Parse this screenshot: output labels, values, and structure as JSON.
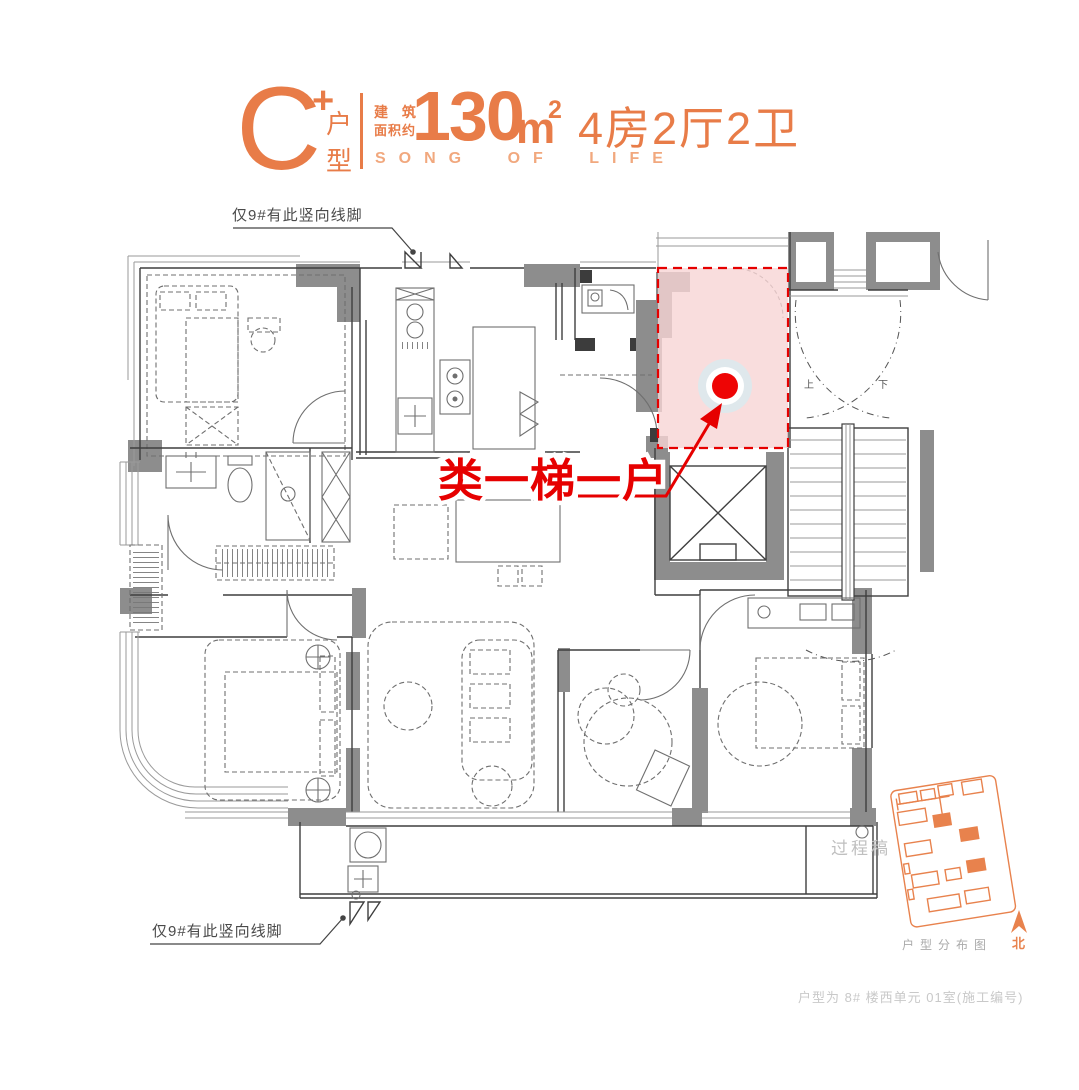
{
  "header": {
    "type_letter": "C",
    "type_plus": "+",
    "type_char_top": "户",
    "type_char_bottom": "型",
    "area_label_line1": "建 筑",
    "area_label_line2": "面积约",
    "area_value": "130",
    "area_unit": "m",
    "area_power": "2",
    "layout": "4房2厅2卫",
    "slogan": "SONG OF LIFE"
  },
  "notes": {
    "top": "仅9#有此竖向线脚",
    "bottom": "仅9#有此竖向线脚"
  },
  "highlight": {
    "label": "类一梯一户"
  },
  "stairs": {
    "up": "上",
    "down": "下"
  },
  "watermark": "过程稿",
  "siteplan": {
    "caption": "户型分布图",
    "north": "北"
  },
  "footer": {
    "caption": "户型为 8# 楼西单元 01室(施工编号)"
  },
  "colors": {
    "accent": "#E87C48",
    "accent_light": "#F1A87E",
    "highlight_red": "#E60000",
    "highlight_pink": "#F7D4D4",
    "wall_gray": "#8D8D8D",
    "siteplan_orange": "#E8824D"
  }
}
